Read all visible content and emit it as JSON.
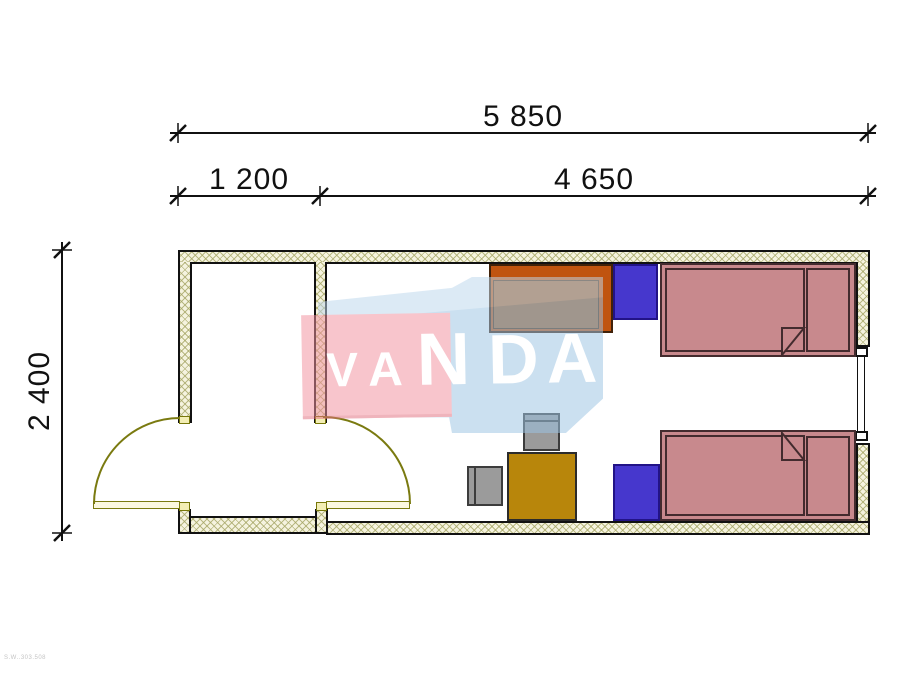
{
  "page": {
    "type": "architectural floor plan",
    "background": "#ffffff"
  },
  "dimensions": {
    "total_width": "5 850",
    "entry_width": "1 200",
    "main_width": "4 650",
    "depth": "2 400"
  },
  "watermark": {
    "text": "VANDA",
    "letters": [
      "V",
      "A",
      "N",
      "D",
      "A"
    ],
    "band_color": "#f2919f",
    "box_color": "#9cc4e4",
    "letter_color": "#ffffff"
  },
  "footer": {
    "code": "S.W..303.508"
  },
  "palette": {
    "wall_fill": "#f5f3df",
    "wall_hatch": "#a5a564",
    "wall_outline": "#111111",
    "door_symbol": "#7a7a10",
    "bed": "#c8898d",
    "nightstand": "#4637cd",
    "wardrobe": "#c0540f",
    "wardrobe_inner": "#a5642f",
    "desk": "#b8860b",
    "chair": "#9b9b9b",
    "window": "#ffffff"
  }
}
